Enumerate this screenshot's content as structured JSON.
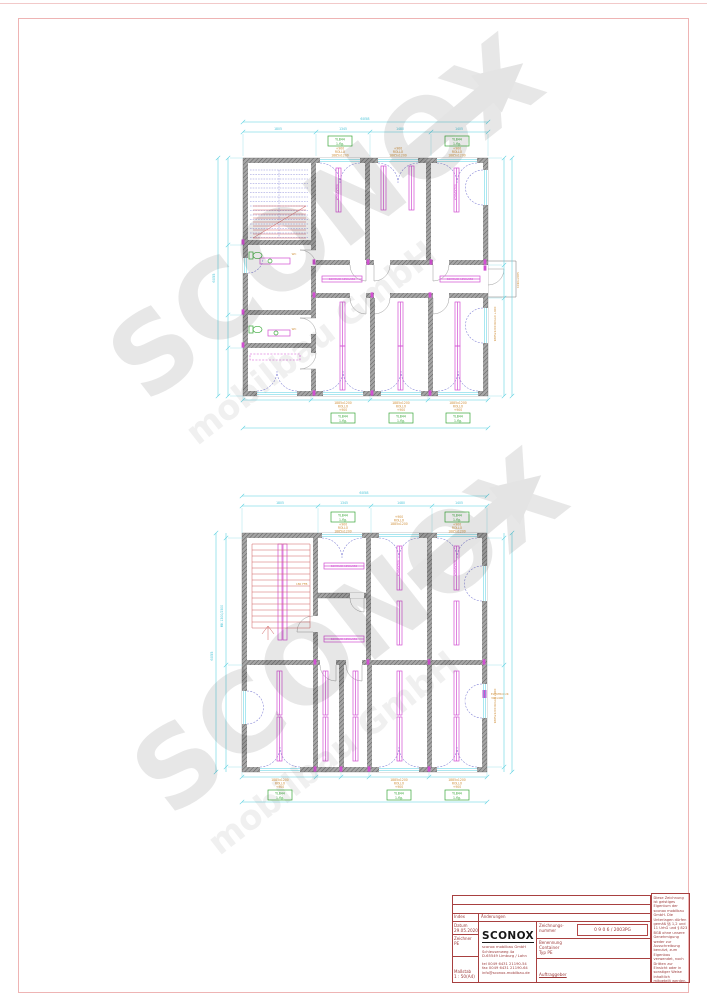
{
  "colors": {
    "dimension_cyan": "#55cfe0",
    "furniture_magenta": "#d24fd2",
    "door_arc_violet": "#8080d5",
    "stairs_red": "#d06060",
    "fixtures_green": "#3aa83a",
    "annotation_orange": "#cf8f3a",
    "wall_gray": "#8a8a8a",
    "titleblock_red": "#a84040",
    "frame_pink": "#eeb4b4",
    "watermark_gray": "#e7e7e7"
  },
  "watermark": {
    "text": "SCONOX",
    "subtext": "mobilbau GmbH"
  },
  "annotations": {
    "window_tag_line1": "YLB44",
    "window_tag_line2": "1-flg.",
    "spec_sill": "+900",
    "spec_rollo": "ROLLO",
    "spec_size": "1885x1200",
    "side_spec": "1885x1200 ROLLO +900",
    "door_spec": "1010x2065",
    "stair_note": "180 FFB",
    "elektro_line1": "ELEKTRO-UK",
    "elektro_line2": "300x400",
    "shelf_label": "SCHRANK 1950x550",
    "radiator_label": "KONVEKTOR",
    "wc_label": "WC"
  },
  "dimensions": {
    "total_width": "6058",
    "total_height": "6055",
    "seg_a": "1805",
    "seg_b": "1345",
    "seg_c": "1480",
    "seg_d": "1405",
    "left_note": "MK 1300/2500"
  },
  "titleblock": {
    "index_label": "Index",
    "index_value": "Änderungen",
    "datum_label": "Datum",
    "datum_value": "29.05.2020",
    "zeichner_label": "Zeichner",
    "zeichner_value": "PE",
    "massstab_label": "Maßstab",
    "massstab_value": "1 : 50(A4)",
    "logo": "SCONOX",
    "company_line1": "sconox mobilbau GmbH",
    "company_line2": "Schleusenweg 4a",
    "company_line3": "D-65549 Limburg / Lahn",
    "tel": "tel  0049 6431 21190-54",
    "fax": "fax 0049 6431 21190-64",
    "email": "info@sconox-mobilbau.de",
    "drawingno_label1": "Zeichnungs-",
    "drawingno_label2": "nummer",
    "drawingno_value": "0 9 0 6 / 2003PG",
    "benennung_label": "Benennung",
    "benennung_line1": "Container",
    "benennung_line2": "Typ PE",
    "auftraggeber_label": "Auftraggeber",
    "copyright": "Diese Zeichnung ist geistiges Eigentum der sconox mobilbau GmbH. Die Unterlagen dürfen gemäß §§ 1,2 und 11 UrhG und § 823 BGB ohne unsere Genehmigung weder zur Ausschreibung benutzt, zum Eigenbau verwendet, noch Dritten zur Einsicht oder in sonstiger Weise inhaltlich mitgeteilt werden. Schadenersatzansprüche behalten wir uns bei Nichtbeachtung vor !"
  }
}
